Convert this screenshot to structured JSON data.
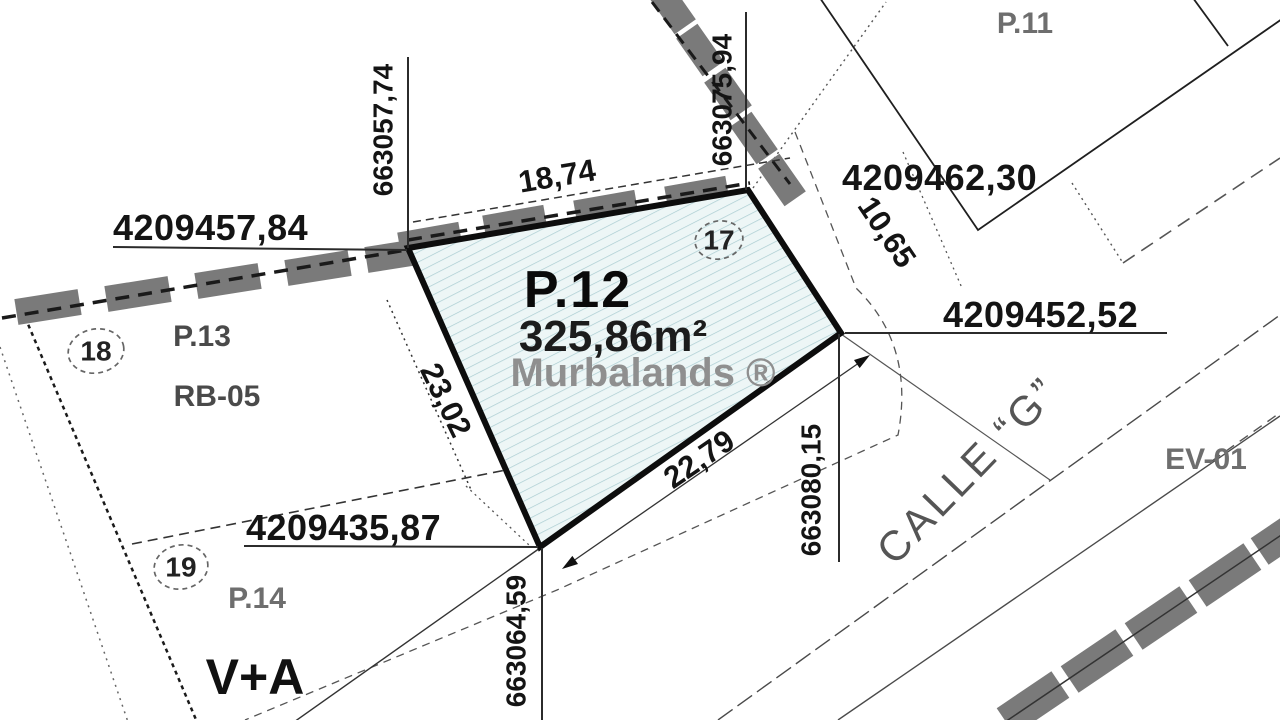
{
  "parcel": {
    "name": "P.12",
    "area": "325,86m²",
    "watermark": "Murbalands ®",
    "vertex_marker": "17"
  },
  "adjacent": {
    "p11": {
      "name": "P.11"
    },
    "p13": {
      "name": "P.13",
      "zoning": "RB-05",
      "vertex_marker": "18"
    },
    "p14": {
      "name": "P.14",
      "land_use": "V+A",
      "vertex_marker": "19"
    }
  },
  "streets": {
    "calle_g": "CALLE “G”",
    "ev01": "EV-01"
  },
  "coordinates": {
    "nw": {
      "x": "663057,74",
      "y": "4209457,84"
    },
    "ne": {
      "x": "663075,94",
      "y": "4209462,30"
    },
    "e": {
      "x": "663080,15",
      "y": "4209452,52"
    },
    "s": {
      "x": "663064,59",
      "y": "4209435,87"
    }
  },
  "dimensions": {
    "north_side": "18,74",
    "east_side": "10,65",
    "southeast_side": "22,79",
    "west_side": "23,02"
  },
  "colors": {
    "parcel_fill": "#edf6f6",
    "parcel_hatch": "#a9ccd1",
    "parcel_border": "#0d0d0d",
    "wall_block": "#7a7a7a",
    "watermark": "#8f8f8f"
  }
}
